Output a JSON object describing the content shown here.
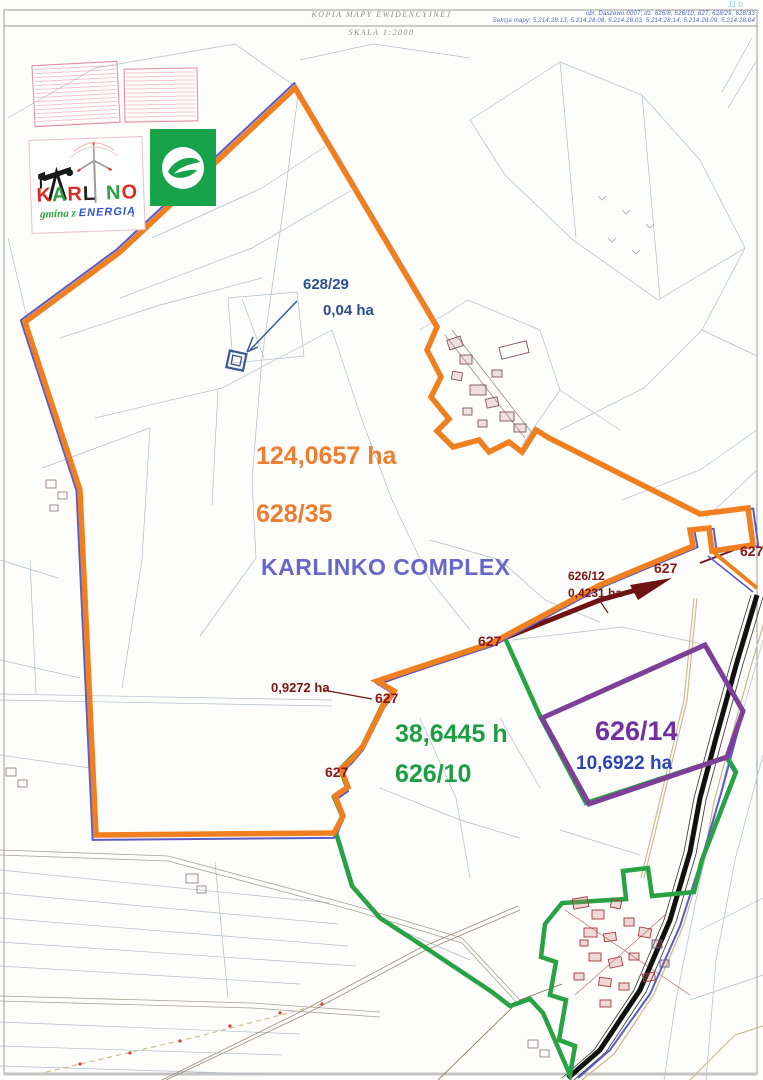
{
  "sheet": {
    "title": "KOPIA MAPY EWIDENCYJNEJ",
    "scale": "SKALA 1:2000",
    "corner_mark": "11 b",
    "register_line1": "obr. Daszewo 0007; dz. 626/8, 626/10, 627, 628/29, 628/33",
    "register_line2": "Sekcja mapy: 5.214.28.13, 5.214.28.08, 5.214.28.03, 5.214.28.14, 5.214.28.09, 5.214.28.04"
  },
  "logo": {
    "letters": [
      {
        "ch": "K",
        "color": "#d93025"
      },
      {
        "ch": "A",
        "color": "#2f9e44"
      },
      {
        "ch": "R",
        "color": "#d93025"
      },
      {
        "ch": "L",
        "color": "#222222"
      },
      {
        "ch": "N",
        "color": "#2f9e44"
      },
      {
        "ch": "O",
        "color": "#d93025"
      }
    ],
    "tagline_script": "gmina z",
    "tagline_caps": "ENERGIĄ"
  },
  "parcels": {
    "p628_29": {
      "id": "628/29",
      "area": "0,04 ha",
      "color": "#2e4d8e"
    },
    "p628_35": {
      "id": "628/35",
      "area": "124,0657 ha",
      "complex_name": "KARLINKO COMPLEX",
      "boundary_color": "#f0801f",
      "label_color": "#ed7d31",
      "name_color": "#6667c9"
    },
    "p626_12": {
      "id": "626/12",
      "area": "0,4231 ha",
      "color": "#7a1414"
    },
    "p627_sliver": {
      "area": "0,9272 ha",
      "color": "#7a1414"
    },
    "p626_10": {
      "id": "626/10",
      "area": "38,6445 h",
      "color": "#1e9e44"
    },
    "p626_14": {
      "id": "626/14",
      "area": "10,6922 ha",
      "id_color": "#7030a0",
      "area_color": "#2e45b0"
    }
  },
  "road_labels": [
    {
      "text": "627"
    },
    {
      "text": "627"
    },
    {
      "text": "627"
    },
    {
      "text": "627"
    },
    {
      "text": "627"
    }
  ]
}
